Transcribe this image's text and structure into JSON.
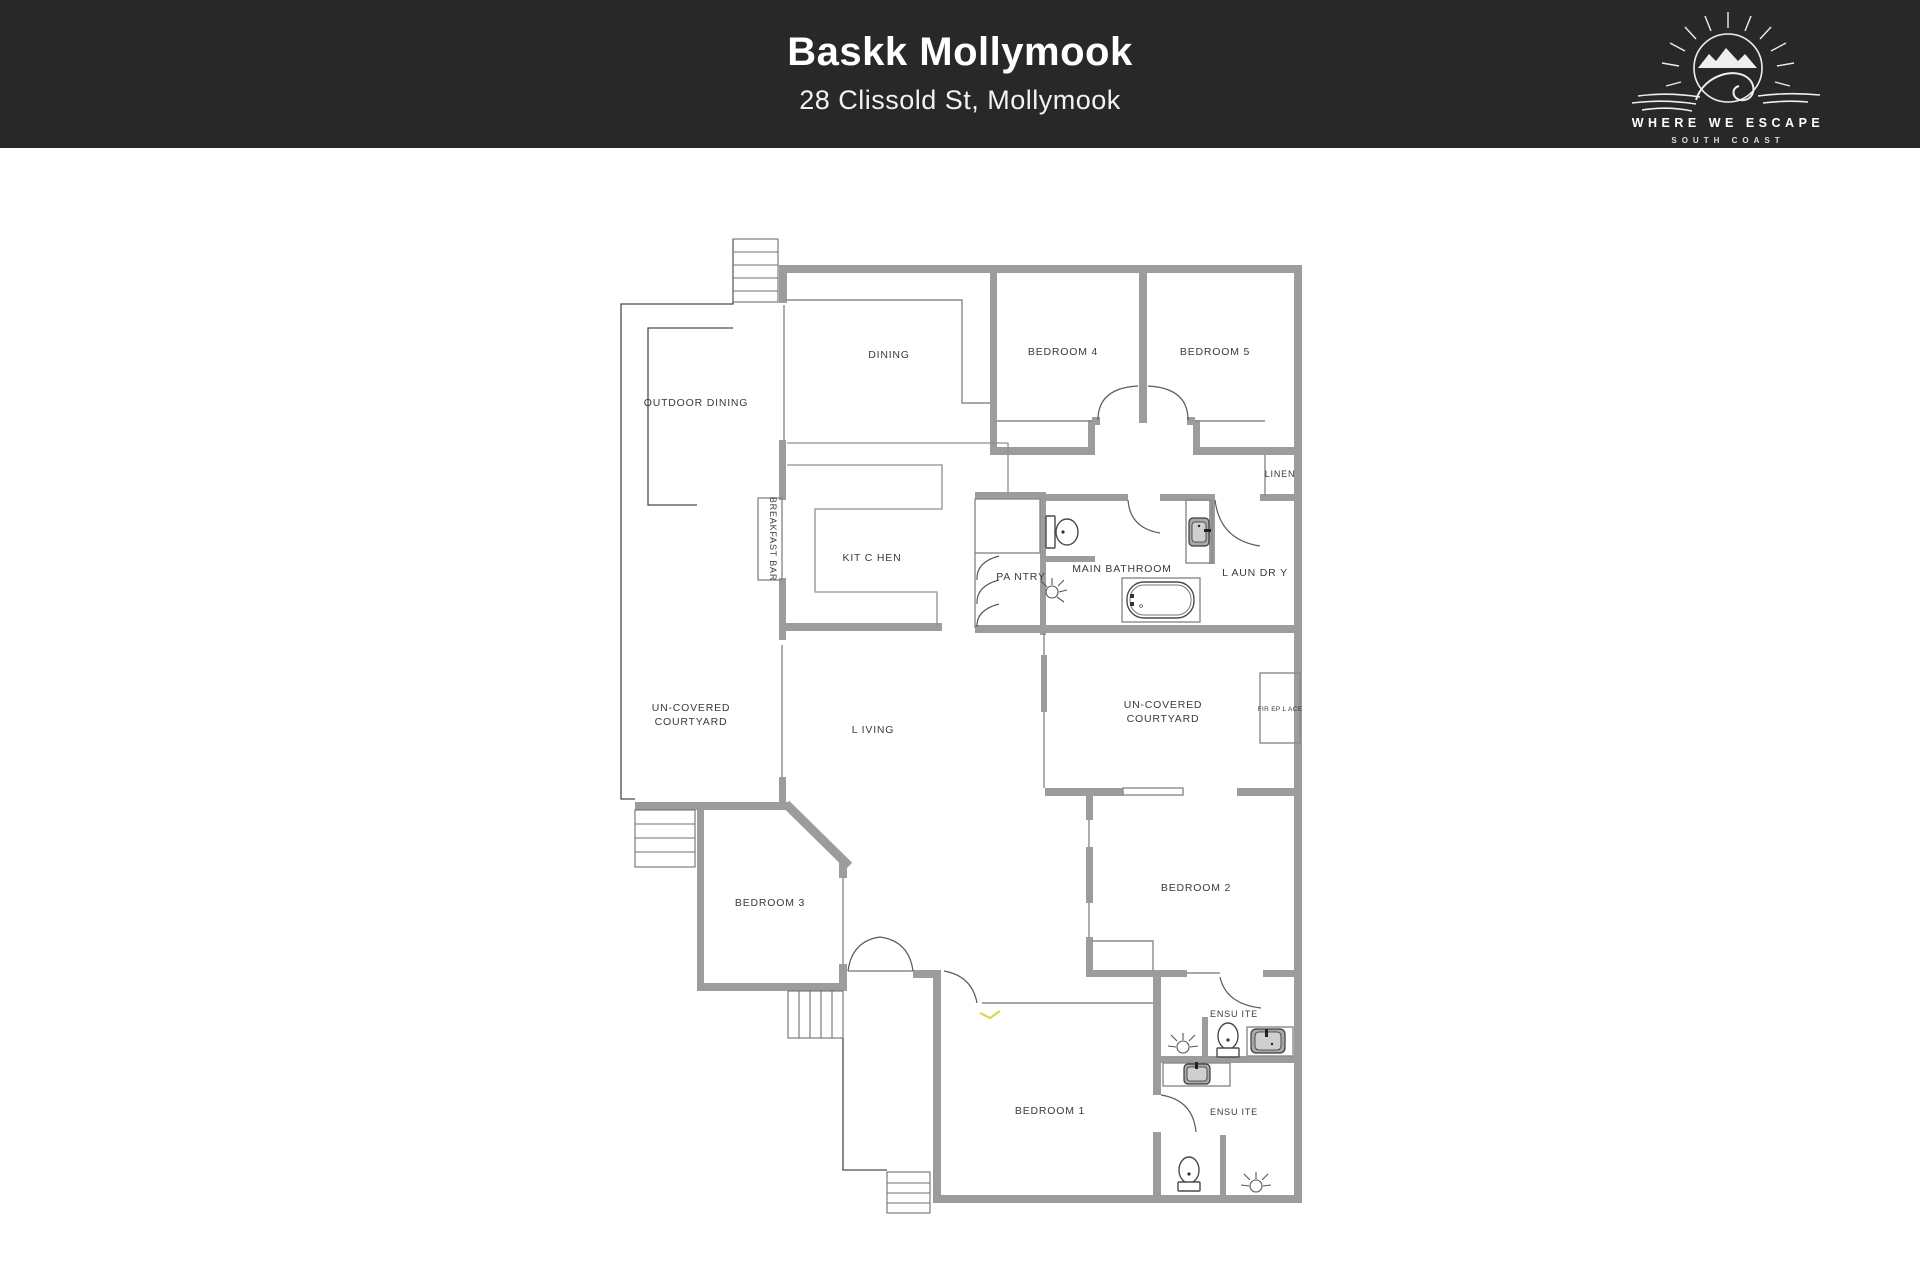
{
  "header": {
    "title": "Baskk Mollymook",
    "subtitle": "28 Clissold St, Mollymook",
    "background": "#282828"
  },
  "logo": {
    "brand_line1": "WHERE WE ESCAPE",
    "brand_line2": "SOUTH COAST",
    "icon": "sun-mountains-wave-icon"
  },
  "floorplan": {
    "colors": {
      "thick_wall": "#9c9c9c",
      "thin_wall": "#8a8a8a",
      "outdoor_outline": "#4a4a4a",
      "label_text": "#3a3a3a",
      "highlight_mark": "#d8d84a"
    },
    "rooms": [
      {
        "label": "OUTDOOR DINING"
      },
      {
        "label": "DINING"
      },
      {
        "label": "BEDROOM 4"
      },
      {
        "label": "BEDROOM 5"
      },
      {
        "label": "LINEN"
      },
      {
        "label": "BREAKFAST BAR"
      },
      {
        "label": "KIT C HEN"
      },
      {
        "label": "PA NTRY"
      },
      {
        "label": "MAIN BATHROOM"
      },
      {
        "label": "L AUN DR Y"
      },
      {
        "label": "UN-COVERED",
        "label2": "COURTYARD"
      },
      {
        "label": "UN-COVERED",
        "label2": "COURTYARD"
      },
      {
        "label": "FIR EP L ACE"
      },
      {
        "label": "L IVING"
      },
      {
        "label": "BEDROOM 3"
      },
      {
        "label": "BEDROOM 2"
      },
      {
        "label": "BEDROOM 1"
      },
      {
        "label": "ENSU ITE"
      },
      {
        "label": "ENSU ITE"
      }
    ],
    "fixtures": [
      {
        "name": "toilet-icon",
        "room": "MAIN BATHROOM"
      },
      {
        "name": "toilet-icon",
        "room": "ENSU ITE (top)"
      },
      {
        "name": "toilet-icon",
        "room": "ENSU ITE (bottom)"
      },
      {
        "name": "bathtub-icon",
        "room": "MAIN BATHROOM"
      },
      {
        "name": "sink-icon",
        "room": "MAIN BATHROOM"
      },
      {
        "name": "sink-icon",
        "room": "ENSU ITE (top)"
      },
      {
        "name": "sink-icon",
        "room": "ENSU ITE (bottom)"
      },
      {
        "name": "ceiling-light-icon",
        "room": "MAIN BATHROOM"
      },
      {
        "name": "ceiling-light-icon",
        "room": "ENSU ITE (top)"
      },
      {
        "name": "ceiling-light-icon",
        "room": "ENSU ITE (bottom)"
      },
      {
        "name": "stairs",
        "count": 4
      }
    ]
  }
}
